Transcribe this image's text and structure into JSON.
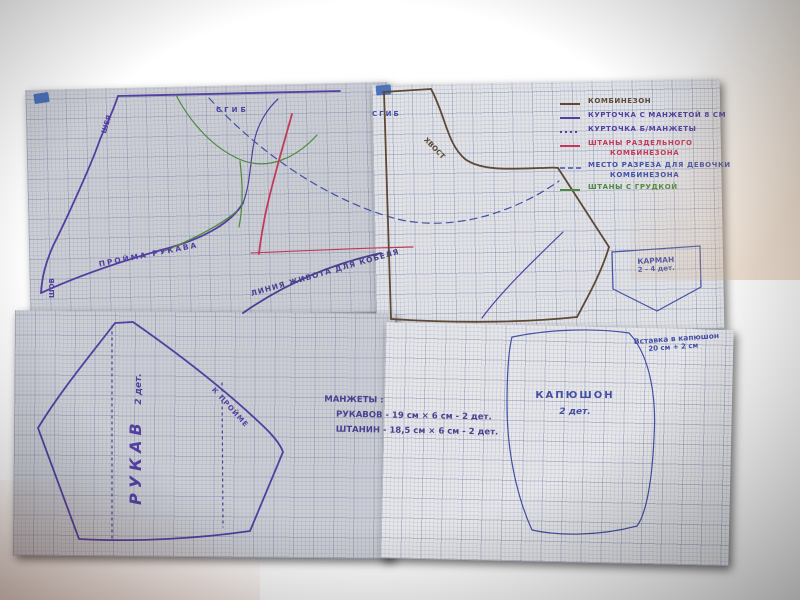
{
  "colors": {
    "wood_dark": "#1d0b06",
    "wood_light": "#6e331c",
    "paper": "#ccced4",
    "paper_bright": "#e2e3e7",
    "tape_blue": "#3c67b6",
    "ink_purple": "#523fa0",
    "ink_blue": "#4450a5",
    "ink_dark": "#4a4090",
    "outline_brown": "#5d4936",
    "outline_red": "#c23a58",
    "outline_green": "#4e8a3d"
  },
  "legend": {
    "items": [
      {
        "label": "КОМБИНЕЗОН",
        "style": "solid",
        "color": "#5d4936"
      },
      {
        "label": "КУРТОЧКА С МАНЖЕТОЙ 8 СМ",
        "style": "solid",
        "color": "#523fa0"
      },
      {
        "label": "КУРТОЧКА Б/МАНЖЕТЫ",
        "style": "dotted",
        "color": "#523fa0"
      },
      {
        "label": "ШТАНЫ РАЗДЕЛЬНОГО",
        "label2": "КОМБИНЕЗОНА",
        "style": "solid",
        "color": "#c23a58"
      },
      {
        "label": "МЕСТО РАЗРЕЗА ДЛЯ ДЕВОЧКИ",
        "label2": "КОМБИНЕЗОНА",
        "style": "dashed",
        "color": "#4450a5"
      },
      {
        "label": "ШТАНЫ С ГРУДКОЙ",
        "style": "solid",
        "color": "#4e8a3d"
      }
    ]
  },
  "body_piece": {
    "fold_label": "СГИБ",
    "neck_label": "ШЕЯ",
    "seam_label": "ШОВ",
    "armhole_label": "ПРОЙМА РУКАВА",
    "belly_label": "ЛИНИЯ ЖИВОТА ДЛЯ КОБЕЛЯ"
  },
  "back_piece": {
    "fold_label": "СГИБ",
    "tail_label": "ХВОСТ"
  },
  "pocket": {
    "title": "КАРМАН",
    "qty": "2 - 4 дет."
  },
  "cuffs": {
    "title": "МАНЖЕТЫ :",
    "sleeves_row": "РУКАВОВ - 19 см × 6 см - 2 дет.",
    "pants_row": "ШТАНИН - 18,5 см × 6 см - 2 дет."
  },
  "sleeve": {
    "title": "РУКАВ",
    "qty": "2 дет.",
    "edge_label": "К ПРОЙМЕ"
  },
  "hood": {
    "title": "КАПЮШОН",
    "qty": "2 дет.",
    "insert_title": "Вставка в капюшон",
    "insert_size": "20 см + 2 см"
  }
}
